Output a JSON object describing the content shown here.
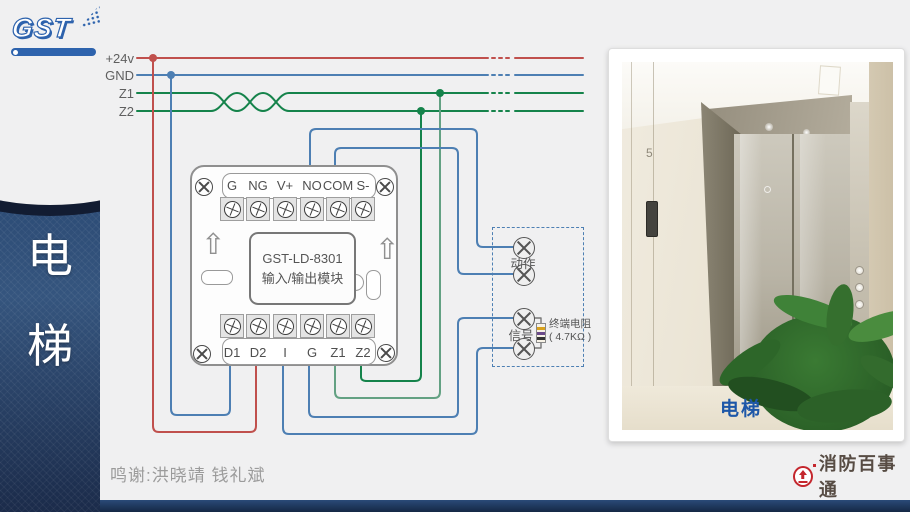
{
  "sidebar": {
    "logo": "GST",
    "title": "电\n梯"
  },
  "bus": {
    "labels": [
      "+24v",
      "GND",
      "Z1",
      "Z2"
    ]
  },
  "module": {
    "model": "GST-LD-8301",
    "name": "输入/输出模块",
    "top_terminals": [
      "G",
      "NG",
      "V+",
      "NO",
      "COM",
      "S-"
    ],
    "bottom_terminals": [
      "D1",
      "D2",
      "I",
      "G",
      "Z1",
      "Z2"
    ]
  },
  "junction": {
    "action_label": "动作",
    "signal_label": "信号",
    "resistor_name": "终端电阻",
    "resistor_value": "( 4.7KΩ )"
  },
  "photo": {
    "caption": "电梯",
    "floor_sign": "5"
  },
  "footer": {
    "credits": "鸣谢:洪晓靖 钱礼斌",
    "brand": "消防百事通"
  },
  "colors": {
    "wire_red": "#c0504d",
    "wire_blue": "#4d7fb3",
    "wire_green": "#15834b",
    "wire_green_light": "#63a183",
    "sidebar_navy": "#2d4c76",
    "caption_blue": "#1d57a8",
    "brand_red": "#c4262d",
    "background": "#f0f0f1"
  }
}
